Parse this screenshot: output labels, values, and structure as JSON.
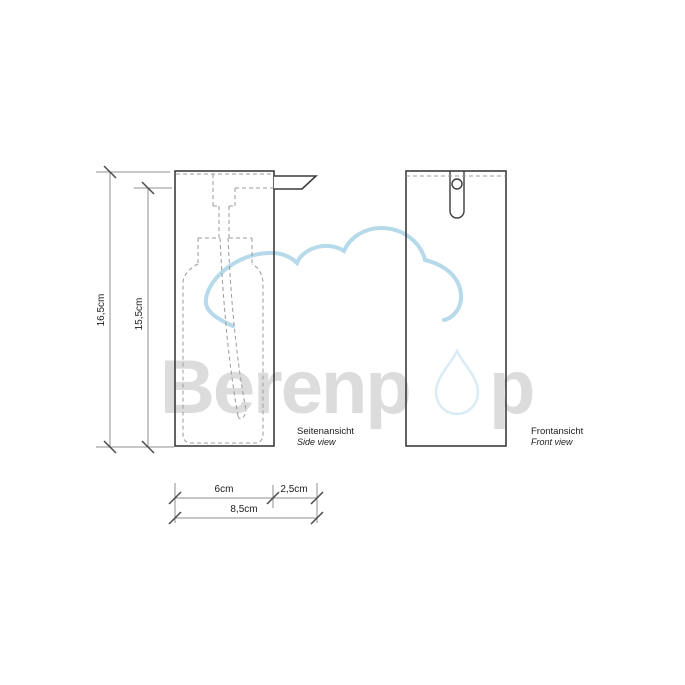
{
  "views": {
    "side": {
      "label_de": "Seitenansicht",
      "label_en": "Side view"
    },
    "front": {
      "label_de": "Frontansicht",
      "label_en": "Front view"
    }
  },
  "dimensions": {
    "total_height": "16,5cm",
    "body_height": "15,5cm",
    "depth_body": "6cm",
    "depth_spout": "2,5cm",
    "depth_total": "8,5cm"
  },
  "watermark": {
    "brand": "Berenpop",
    "text_before_drop": "Berenp",
    "text_after_drop": "p",
    "text_color": "#d9d9d9",
    "cloud_color": "#b7daeb",
    "drop_color": "#d9ecf6"
  },
  "colors": {
    "outline": "#3c3c3c",
    "hidden_line": "#9b9b9b",
    "dimension_line": "#8f8f8f",
    "tick": "#4a4a4a",
    "label_text": "#1c1c1c",
    "background": "#ffffff"
  }
}
